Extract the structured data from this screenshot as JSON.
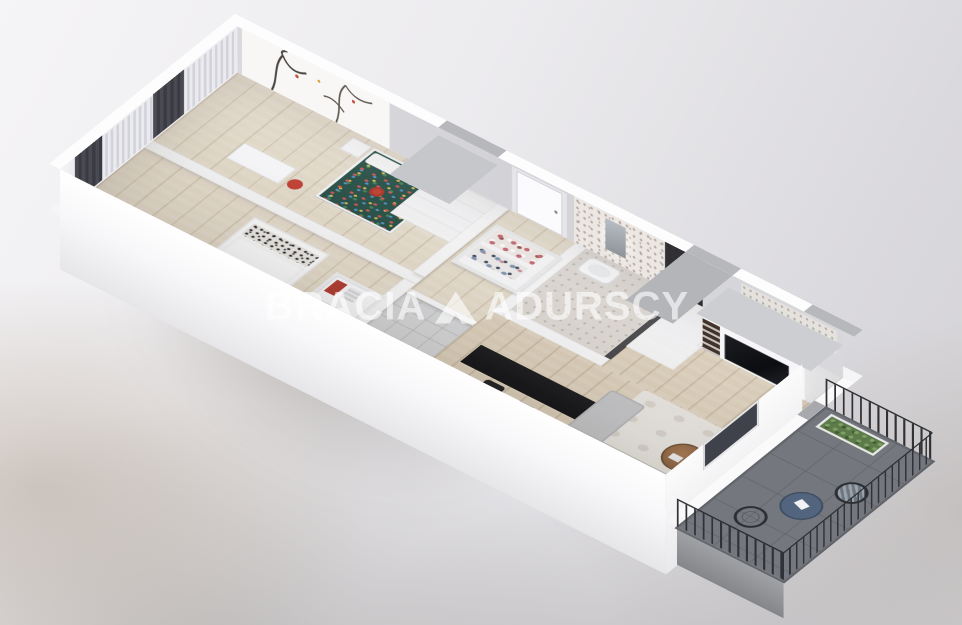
{
  "image_type": "3d-apartment-floor-plan-render",
  "watermark": {
    "brand_left": "BRACIA",
    "brand_right": "ADURSCY",
    "full_name": "BRACIA SADURSCY",
    "logo": "triangle-peak-logo",
    "color": "#ffffff",
    "opacity": 0.62
  },
  "scene": {
    "view": "axonometric bird's-eye cutaway, apartment rotated diagonally, white walls",
    "rooms": [
      {
        "name": "kids-bedroom",
        "floor": "light-wood",
        "items": [
          "tree-mural-wall",
          "floral-single-bed",
          "white-pillow",
          "red-tray",
          "white-desk",
          "red-stool",
          "white-nightstand",
          "white-wardrobe-gray-top",
          "sheer-and-dark-curtains"
        ]
      },
      {
        "name": "master-bedroom",
        "floor": "light-wood",
        "items": [
          "double-bed-white-duvet",
          "patterned-pillows",
          "patterned-throw",
          "foot-bench",
          "open-wardrobe-with-red-clothes",
          "sheer-and-dark-curtains"
        ]
      },
      {
        "name": "hallway",
        "floor": "light-wood",
        "items": [
          "entrance-door",
          "open-closet-with-clothes"
        ]
      },
      {
        "name": "bathroom",
        "floor": "beige-tile",
        "items": [
          "mosaic-tile-wall",
          "mirror",
          "washbasin",
          "dark-shower-glass"
        ]
      },
      {
        "name": "wc",
        "floor": "gray-tile",
        "items": [
          "toilet"
        ]
      },
      {
        "name": "kitchen",
        "floor": "wood",
        "items": [
          "white-cabinets",
          "black-countertop",
          "steel-sink",
          "cooktop",
          "oven",
          "black-island-bar",
          "bar-stools"
        ]
      },
      {
        "name": "living-room",
        "floor": "wood",
        "items": [
          "gray-corner-sofa",
          "white-rug",
          "round-wood-coffee-table",
          "plant",
          "tv-wall-unit",
          "black-tv",
          "dark-bookshelf"
        ]
      },
      {
        "name": "balcony",
        "floor": "dark-gray-concrete",
        "items": [
          "black-metal-railing",
          "round-blue-bistro-table",
          "two-metal-chairs",
          "planter-with-greenery",
          "white-paper"
        ]
      }
    ],
    "palette": {
      "wall_white": "#f8f8f9",
      "wall_face_gray": "#d5d5da",
      "wall_cap_gray": "#b7b8bc",
      "wood_floor": "#dccfba",
      "bath_tile": "#ddd8d3",
      "wc_tile": "#d6d7d9",
      "counter_black": "#1b1c1f",
      "island_black": "#141518",
      "tv_black": "#101114",
      "sofa_gray": "#c5c6c8",
      "rug_offwhite": "#eae7e2",
      "coffee_table_wood": "#9c7452",
      "balcony_floor": "#74777d",
      "railing_black": "#2b2d31",
      "bistro_table_blue": "#52647e",
      "kids_bed_teal": "#1f4a40",
      "accent_red": "#c0392b",
      "curtain_dark": "#46464e",
      "greenery": "#5c7a4a",
      "background_top": "#f5f4f6",
      "background_bottom": "#b9aFA6"
    }
  }
}
